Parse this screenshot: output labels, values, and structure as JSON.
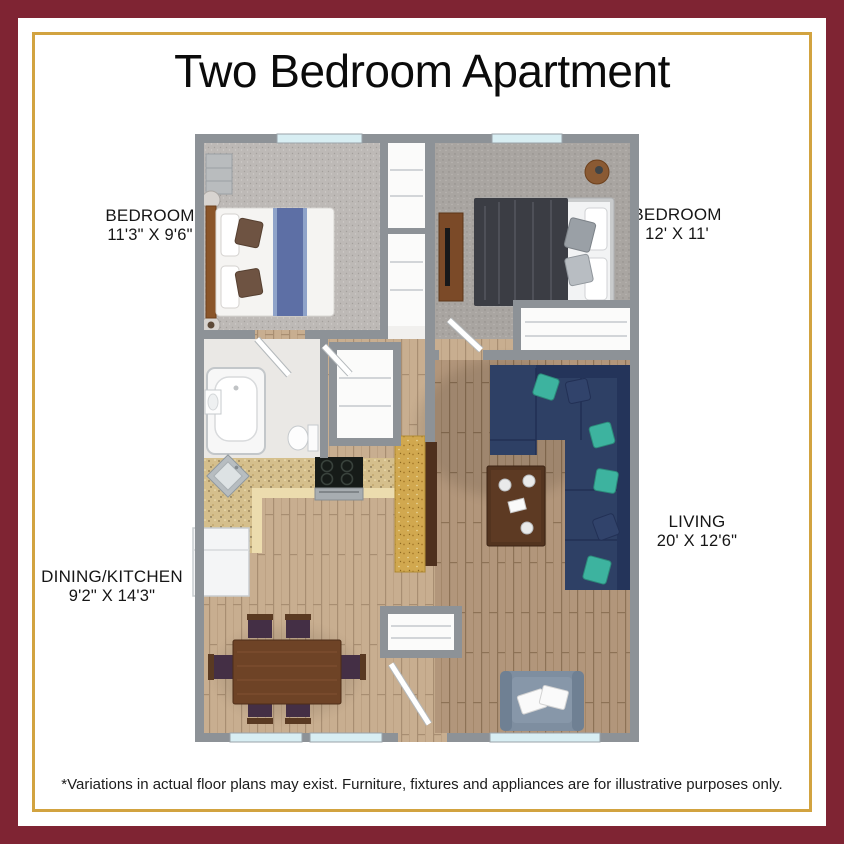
{
  "title": "Two Bedroom Apartment",
  "disclaimer": "*Variations in actual floor plans may exist. Furniture, fixtures and appliances are for illustrative purposes only.",
  "rooms": [
    {
      "name": "BEDROOM",
      "dims": "11'3\" X 9'6\""
    },
    {
      "name": "BEDROOM",
      "dims": "12' X 11'"
    },
    {
      "name": "LIVING",
      "dims": "20' X 12'6\""
    },
    {
      "name": "DINING/KITCHEN",
      "dims": "9'2\" X 14'3\""
    }
  ],
  "colors": {
    "maroon": "#7f2433",
    "gold": "#d2a340",
    "wall": "#8d9297",
    "carpet1": "#bdb9b6",
    "carpet2": "#a9a5a1",
    "woodLight": "#c8ae90",
    "woodDark": "#b2967b",
    "tile": "#eae8e5",
    "granite": "#d5bf8c",
    "graniteEdge": "#ecdcae",
    "island": "#d1a84f",
    "islandBase": "#4e301d",
    "sofa": "#2e4065",
    "sofaDark": "#24345a",
    "teal": "#3db39f",
    "diningTable": "#6e4326",
    "coffeeTable": "#53341f",
    "chairSeat": "#442f45",
    "blanket": "#3b3d44",
    "bedRunner": "#5d6fa5",
    "headboard": "#8a5529",
    "dresser": "#7b4a28",
    "armchair": "#7e8ea0",
    "window": "#d8eef3"
  }
}
